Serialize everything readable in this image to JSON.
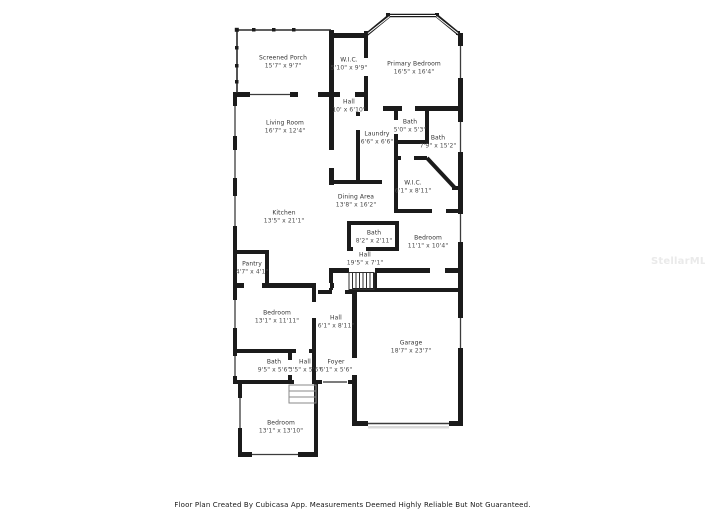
{
  "page": {
    "background": "#ffffff",
    "type": "floor-plan",
    "creator_note": "Floor Plan Created By Cubicasa App. Measurements Deemed Highly Reliable But Not Guaranteed."
  },
  "colors": {
    "wall": "#1b1b1b",
    "window_line": "#3c3c3c",
    "label_text": "#3b3b3b",
    "watermark": "#eaeaea"
  },
  "watermark": "StellarMLS",
  "footer": "Floor Plan Created By Cubicasa App. Measurements Deemed Highly Reliable But Not Guaranteed.",
  "rooms": [
    {
      "name": "Screened Porch",
      "dims": "15'7\" x 9'7\""
    },
    {
      "name": "W.I.C.",
      "dims": "5'10\" x 9'9\""
    },
    {
      "name": "Primary Bedroom",
      "dims": "16'5\" x 16'4\""
    },
    {
      "name": "Hall",
      "dims": "10' x 6'10\""
    },
    {
      "name": "Living Room",
      "dims": "16'7\" x 12'4\""
    },
    {
      "name": "Laundry",
      "dims": "6'6\" x 6'6\""
    },
    {
      "name": "Bath",
      "dims": "5'0\" x 5'3\""
    },
    {
      "name": "Bath",
      "dims": "7'9\" x 15'2\""
    },
    {
      "name": "W.I.C.",
      "dims": "6'1\" x 8'11\""
    },
    {
      "name": "Dining Area",
      "dims": "13'8\" x 16'2\""
    },
    {
      "name": "Kitchen",
      "dims": "13'5\" x 21'1\""
    },
    {
      "name": "Bath",
      "dims": "8'2\" x 2'11\""
    },
    {
      "name": "Bedroom",
      "dims": "11'1\" x 10'4\""
    },
    {
      "name": "Hall",
      "dims": "19'5\" x 7'1\""
    },
    {
      "name": "Pantry",
      "dims": "4'7\" x 4'1\""
    },
    {
      "name": "Bedroom",
      "dims": "13'1\" x 11'11\""
    },
    {
      "name": "Hall",
      "dims": "6'1\" x 8'11\""
    },
    {
      "name": "Garage",
      "dims": "18'7\" x 23'7\""
    },
    {
      "name": "Bath",
      "dims": "9'5\" x 5'6\""
    },
    {
      "name": "Hall",
      "dims": "3'5\" x 5'6\""
    },
    {
      "name": "Foyer",
      "dims": "6'1\" x 5'6\""
    },
    {
      "name": "Bedroom",
      "dims": "13'1\" x 13'10\""
    }
  ]
}
